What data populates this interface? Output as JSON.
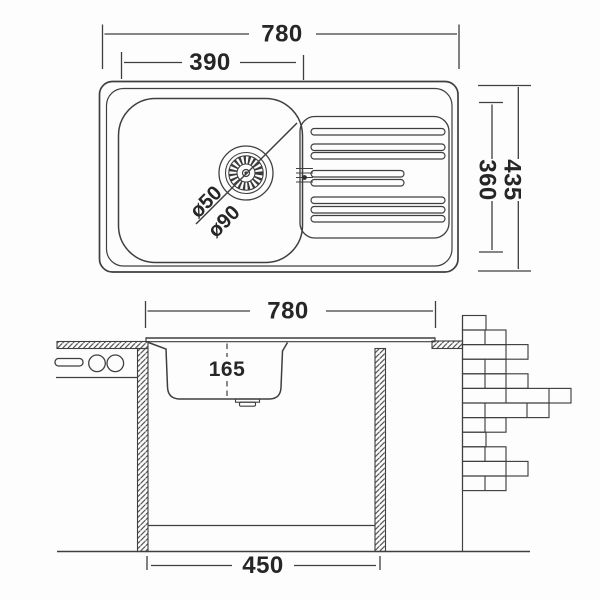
{
  "title": "Inset kitchen sink installation drawing",
  "colors": {
    "line": "#3f3f3f",
    "text": "#262626",
    "background": "#fdfdfd"
  },
  "top_view": {
    "width_overall": "780",
    "width_bowl": "390",
    "depth_overall": "435",
    "depth_inner": "360",
    "drain_diameter_small": "ø50",
    "drain_diameter_large": "ø90"
  },
  "section_view": {
    "width_overall": "780",
    "bowl_depth": "165",
    "cabinet_width": "450"
  }
}
